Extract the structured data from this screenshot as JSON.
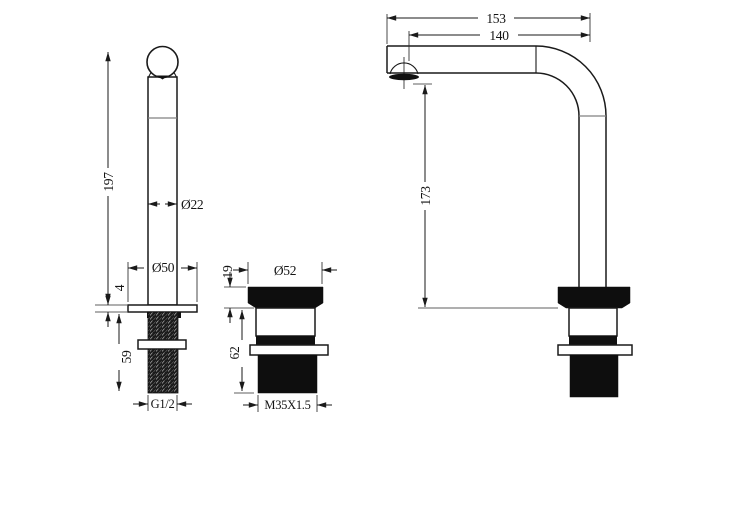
{
  "drawing": {
    "colors": {
      "line": "#1a1a1a",
      "fill_dark": "#0e0e0e",
      "seam_gray": "#808080",
      "background": "#ffffff"
    },
    "dims": {
      "handle": {
        "height": "197",
        "tube_diameter": "Ø22",
        "base_diameter": "Ø50",
        "base_thickness": "4",
        "shank_length": "59",
        "thread": "G1/2"
      },
      "cartridge": {
        "cap_height": "19",
        "cap_diameter": "Ø52",
        "body_height": "62",
        "thread": "M35X1.5"
      },
      "spout": {
        "length_overall": "153",
        "length_to_aerator": "140",
        "height": "173"
      }
    }
  }
}
